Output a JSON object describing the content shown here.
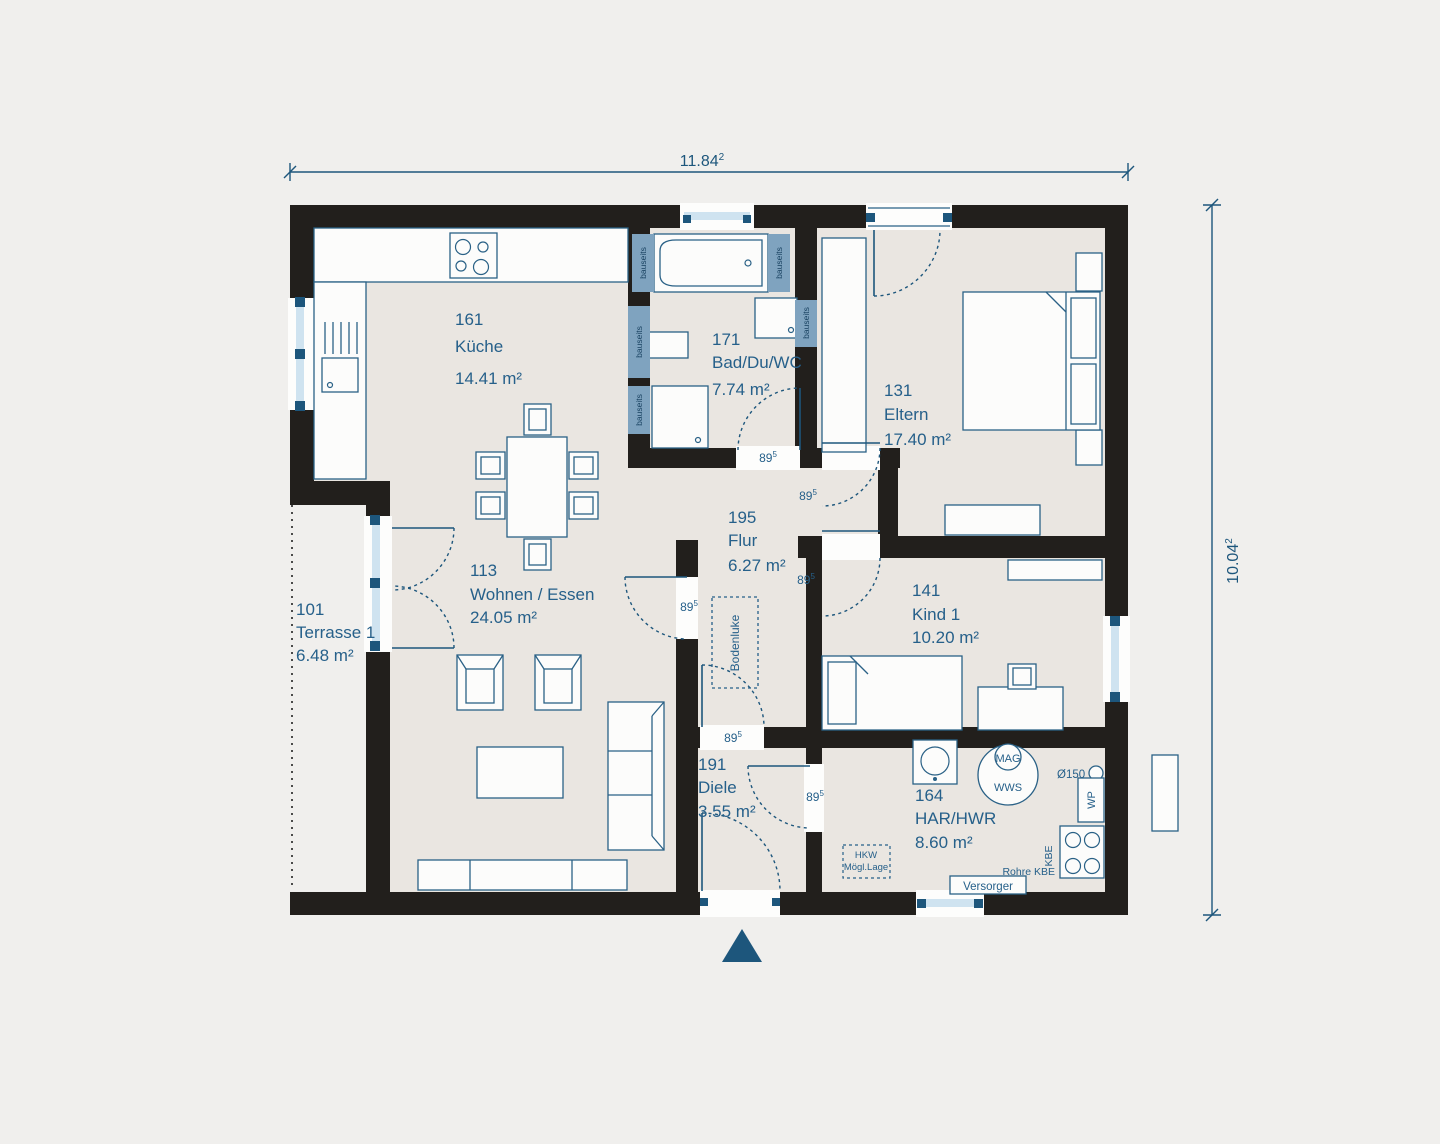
{
  "plan": {
    "dimensions": {
      "width_value": "11.84",
      "width_sup": "2",
      "height_value": "10.04",
      "height_sup": "2"
    },
    "door_width": {
      "value": "89",
      "sup": "5"
    },
    "rooms": [
      {
        "number": "101",
        "name": "Terrasse 1",
        "area": "6.48 m²"
      },
      {
        "number": "113",
        "name": "Wohnen / Essen",
        "area": "24.05 m²"
      },
      {
        "number": "131",
        "name": "Eltern",
        "area": "17.40 m²"
      },
      {
        "number": "141",
        "name": "Kind 1",
        "area": "10.20 m²"
      },
      {
        "number": "161",
        "name": "Küche",
        "area": "14.41 m²"
      },
      {
        "number": "164",
        "name": "HAR/HWR",
        "area": "8.60 m²"
      },
      {
        "number": "171",
        "name": "Bad/Du/WC",
        "area": "7.74 m²"
      },
      {
        "number": "191",
        "name": "Diele",
        "area": "3.55 m²"
      },
      {
        "number": "195",
        "name": "Flur",
        "area": "6.27 m²"
      }
    ],
    "annotations": {
      "bauseits": "bauseits",
      "bodenluke": "Bodenluke",
      "hkw_line1": "HKW",
      "hkw_line2": "Mögl.Lage",
      "versorger": "Versorger",
      "mag": "MAG",
      "wws": "WWS",
      "wp": "WP",
      "kbe": "KBE",
      "rohre_kbe": "Rohre KBE",
      "diameter": "Ø150"
    },
    "colors": {
      "accent": "#26608a",
      "wall": "#221f1c",
      "panel": "#7fa3bf",
      "glass": "#cfe3f0",
      "floor": "#eae6e1",
      "background": "#f0efed"
    }
  }
}
